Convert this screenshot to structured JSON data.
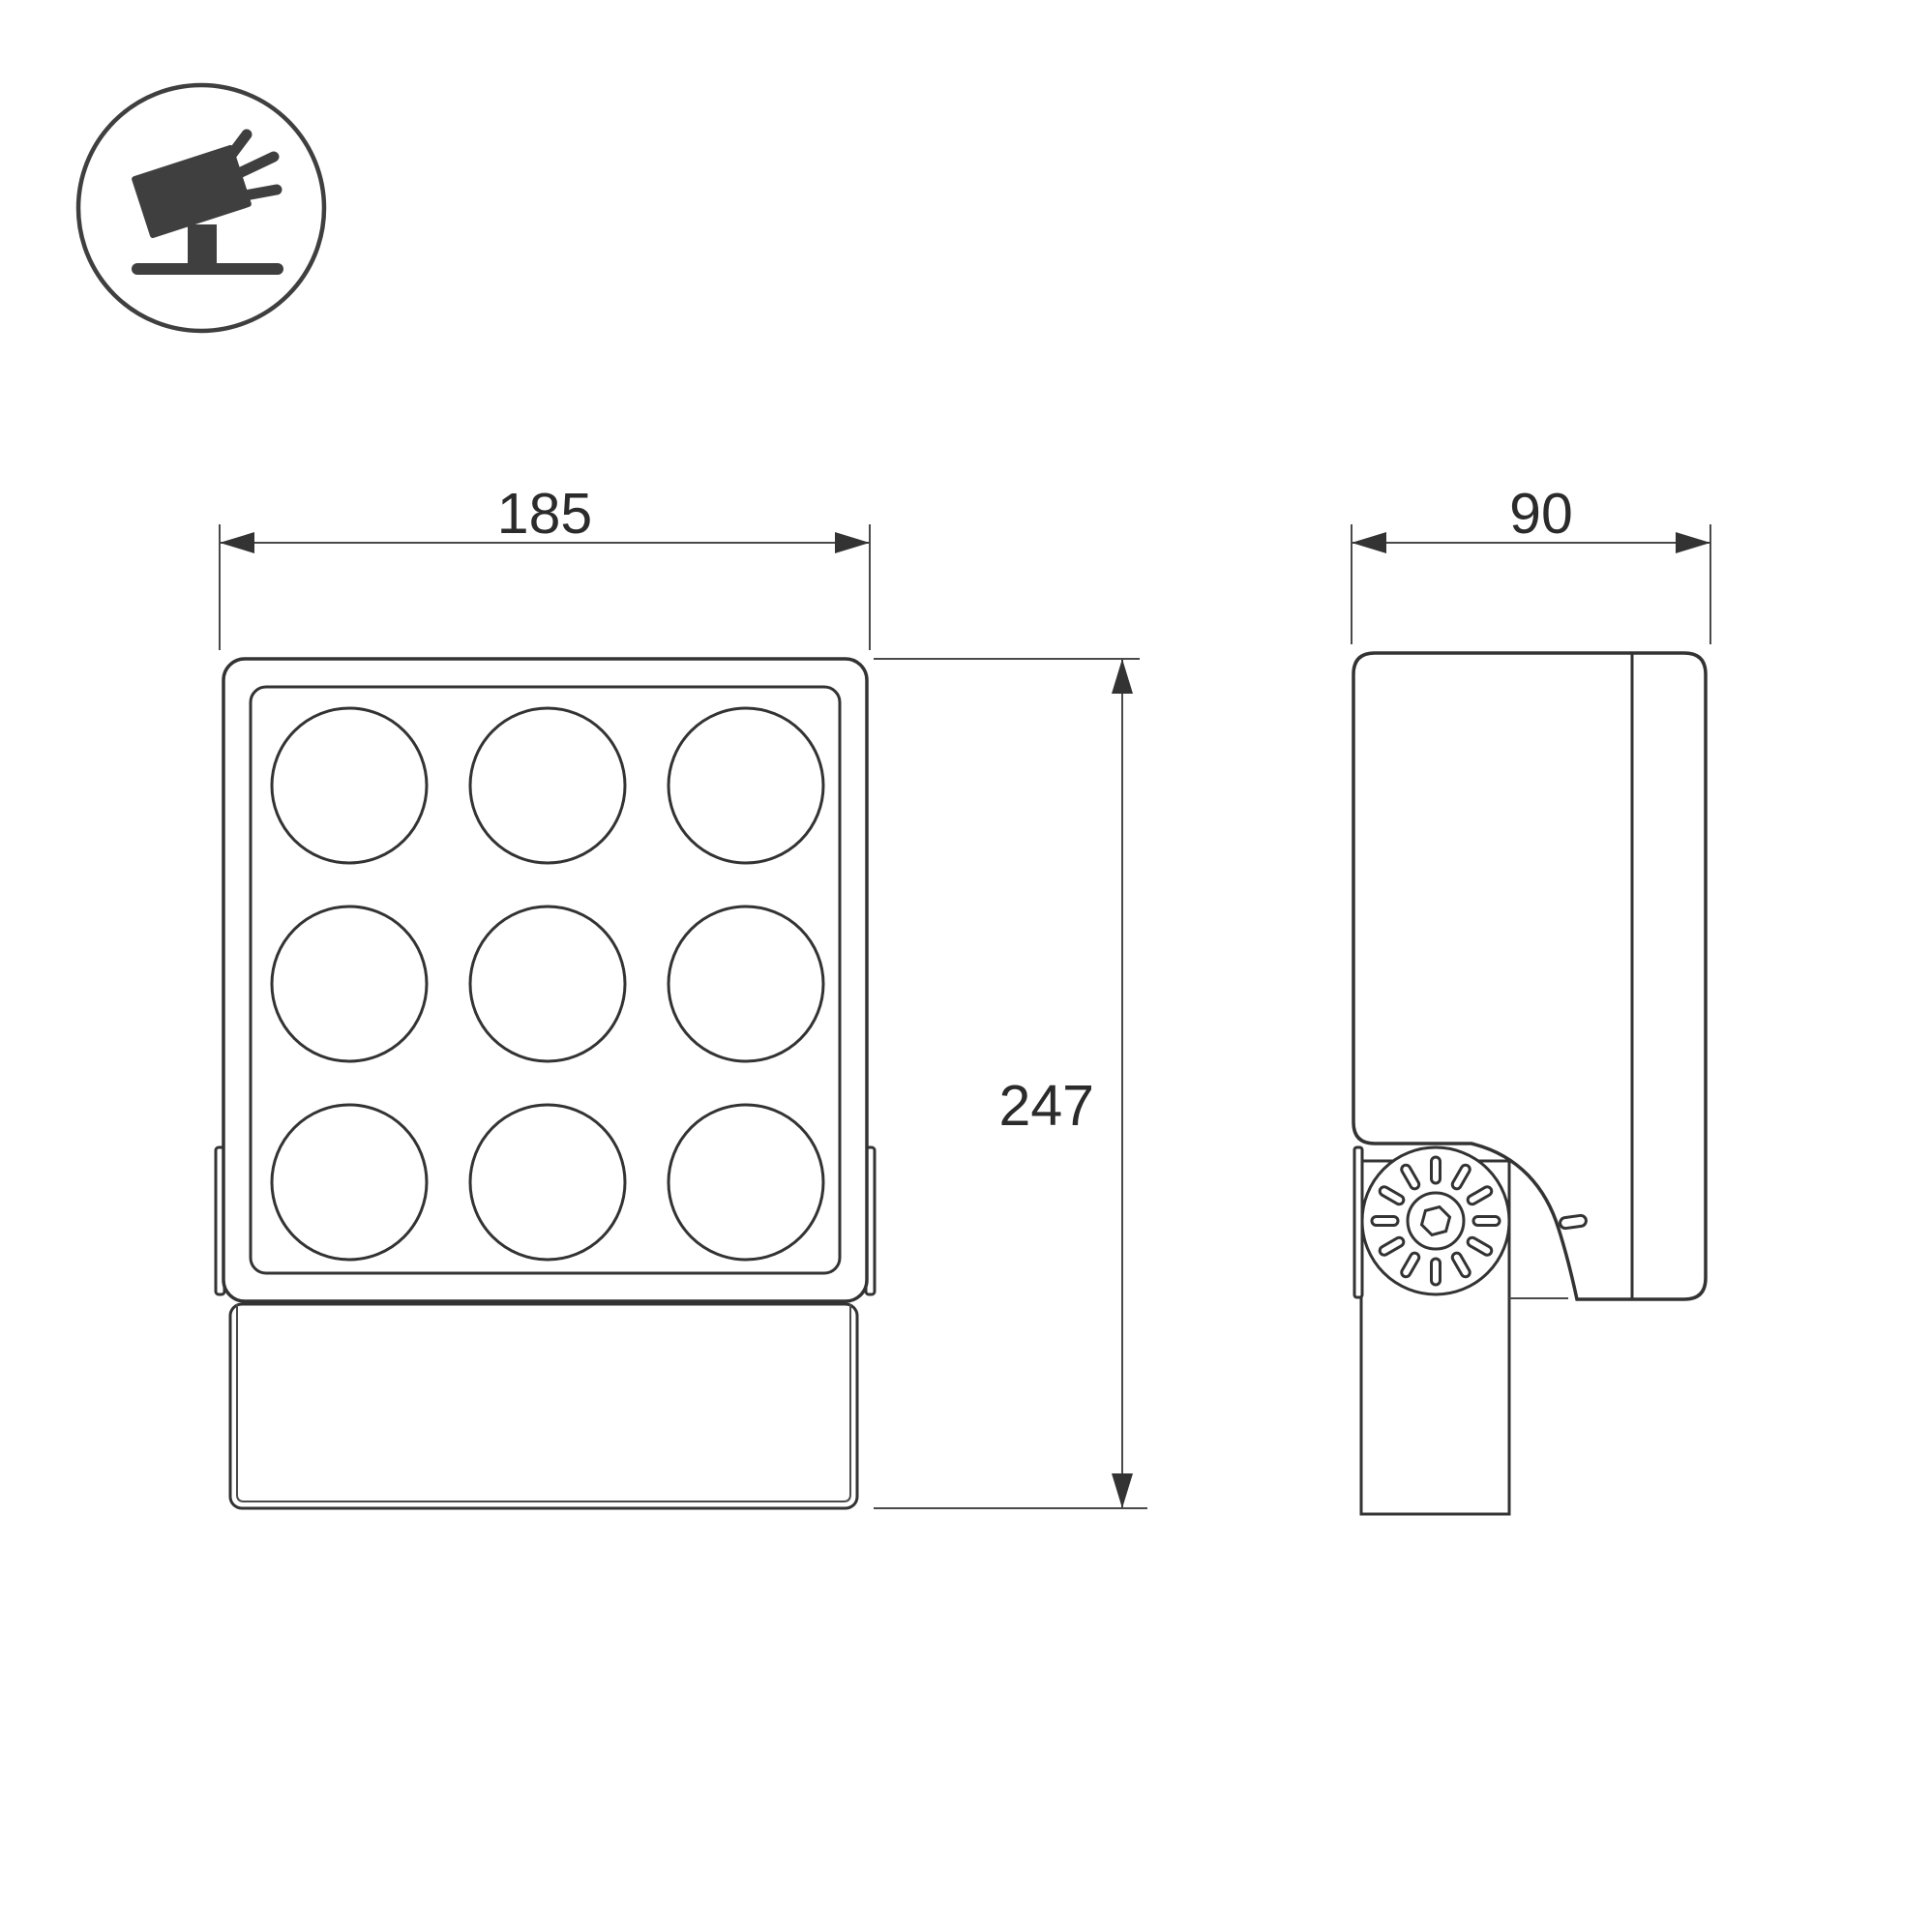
{
  "drawing": {
    "title": "floodlight-dimension-drawing",
    "icon": {
      "name": "tilted-floodlight-on-stand-icon"
    },
    "dimensions": {
      "front_width": "185",
      "front_height": "247",
      "side_depth": "90"
    },
    "front_view": {
      "lens_grid": {
        "rows": 3,
        "cols": 3,
        "count": 9
      }
    },
    "side_view": {
      "knob_slots": 12,
      "screw": "hex-socket"
    },
    "colors": {
      "line": "#333333",
      "text": "#2b2b2b",
      "icon_fill": "#3f3f3f",
      "background": "#ffffff"
    }
  }
}
